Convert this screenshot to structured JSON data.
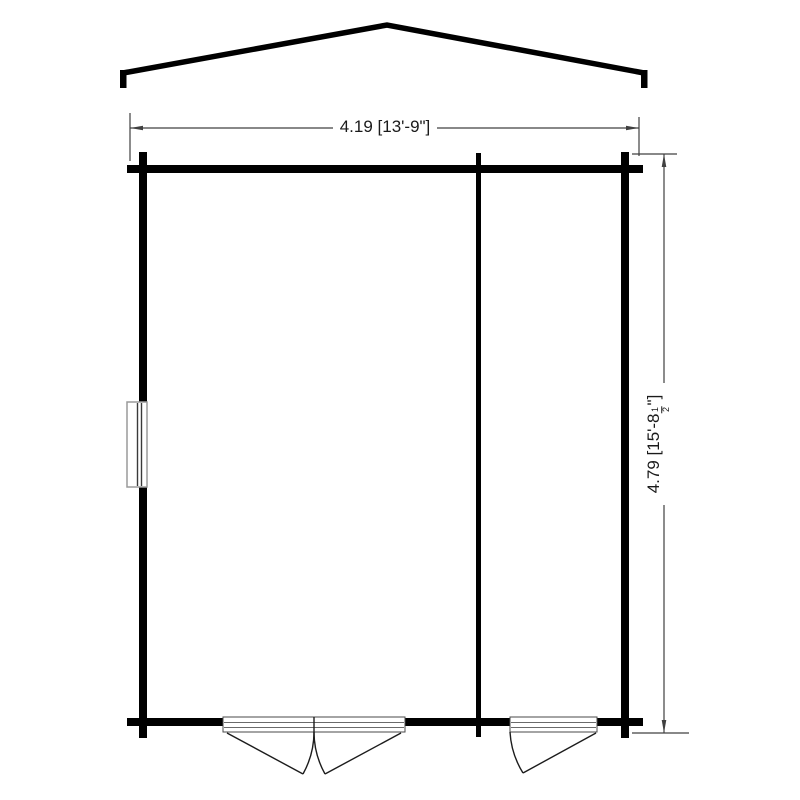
{
  "colors": {
    "wall_color": "#000000",
    "dim_color": "#404040"
  },
  "dimensions": {
    "width": {
      "label": "4.19 [13'-9\"]"
    },
    "height": {
      "prefix": "4.79 [15'-8",
      "fraction_numerator": "1",
      "fraction_denominator": "2",
      "suffix": "\"]"
    }
  }
}
